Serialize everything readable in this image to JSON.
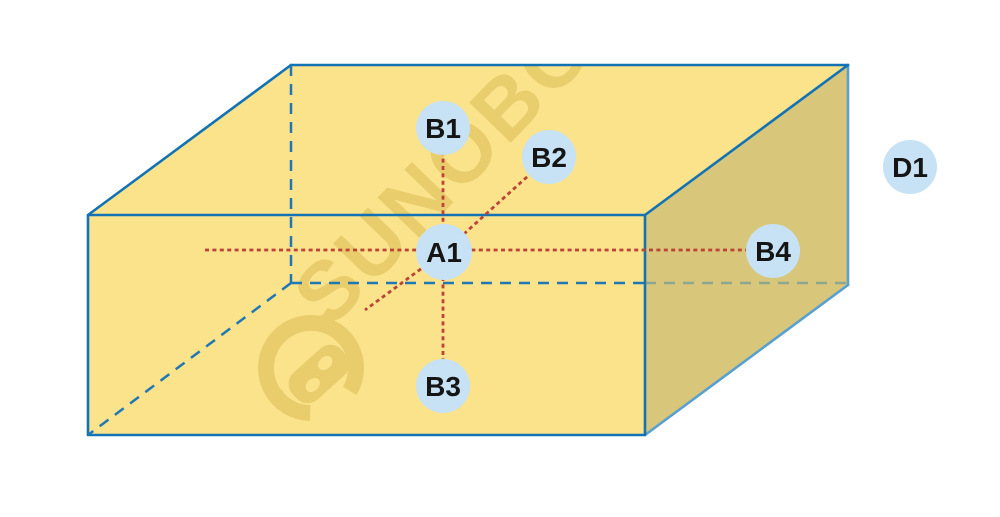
{
  "figure": {
    "type": "cuboid-measurement-point-diagram",
    "watermark": {
      "text": "SUNOBO"
    },
    "nodes": [
      {
        "id": "B1",
        "label": "B1"
      },
      {
        "id": "B2",
        "label": "B2"
      },
      {
        "id": "A1",
        "label": "A1"
      },
      {
        "id": "B3",
        "label": "B3"
      },
      {
        "id": "B4",
        "label": "B4"
      },
      {
        "id": "D1",
        "label": "D1"
      }
    ],
    "colors": {
      "box_face": "#fbe38c",
      "box_side_face": "#d8c67a",
      "edge_blue": "#1173b4",
      "edge_light_blue": "#58a0cf",
      "hidden_edge_blue": "#1f77b4",
      "measure_red": "#bb4338",
      "node_fill": "#c6e2f4",
      "node_text": "#151515",
      "watermark": "#d8b94e",
      "background": "#ffffff"
    }
  }
}
